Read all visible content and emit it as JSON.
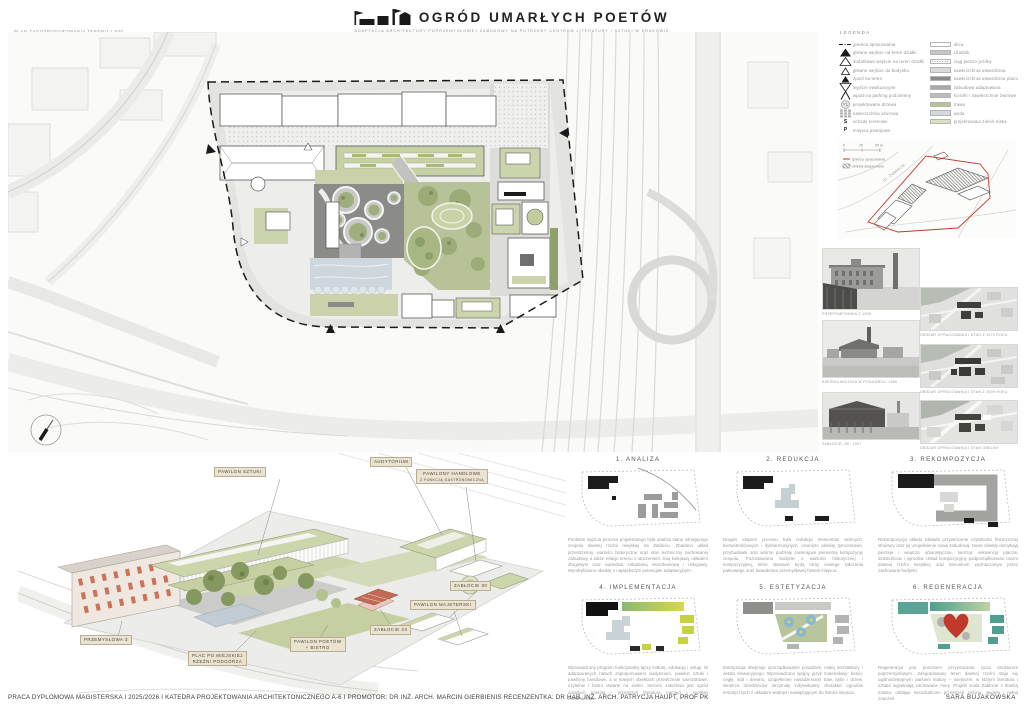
{
  "header": {
    "title": "OGRÓD UMARŁYCH POETÓW",
    "subtitle": "ADAPTACJA ARCHITEKTURY POPRZEMYSŁOWEJ ZABUDOWY NA POTRZEBY CENTRUM LITERATURY I SZTUKI W KRAKOWIE"
  },
  "site_plan": {
    "label": "PLAN ZAGOSPODAROWANIA TERENU 1:500"
  },
  "legend": {
    "title": "LEGENDA",
    "symbols": [
      {
        "label": "granica opracowania"
      },
      {
        "label": "główne wejście na teren działki"
      },
      {
        "label": "dodatkowe wejście na teren działki"
      },
      {
        "label": "główne wejście do budynku"
      },
      {
        "label": "zjazd na teren"
      },
      {
        "label": "wyjście ewakuacyjne"
      },
      {
        "label": "wjazd na parking podziemny"
      },
      {
        "label": "projektowane drzewa"
      },
      {
        "label": "nawierzchnia ażurowa"
      },
      {
        "label": "schody terenowe",
        "glyph": "S"
      },
      {
        "label": "miejsca postojowe",
        "glyph": "P"
      }
    ],
    "surfaces": [
      {
        "color": "#ffffff",
        "label": "ulica"
      },
      {
        "color": "#c6c6c4",
        "label": "chodnik"
      },
      {
        "color": "#ffffff",
        "label": "ciąg pieszo-jezdny"
      },
      {
        "color": "#dadad8",
        "label": "nawierzchnia utwardzona"
      },
      {
        "color": "#8b8b89",
        "label": "nawierzchnia utwardzona placu"
      },
      {
        "color": "#a9a9a7",
        "label": "zabudowa adaptowana"
      },
      {
        "color": "#bcbcba",
        "label": "ścieżki i nawierzchnie żwirowe"
      },
      {
        "color": "#b5c295",
        "label": "trawa"
      },
      {
        "color": "#d3dade",
        "label": "woda"
      },
      {
        "color": "#d9e0c4",
        "label": "projektowana zieleń niska"
      }
    ]
  },
  "location_map": {
    "street_label": "ul. Zabłocie",
    "scale_ticks": [
      "0",
      "25",
      "50 m"
    ],
    "key": [
      {
        "label": "granica opracowania"
      },
      {
        "label": "obiekty adaptowane"
      }
    ]
  },
  "photos": [
    {
      "caption": "PRZEPOMPOWNIA Z 1905"
    },
    {
      "caption": "RZEŹNIA MIEJSKA W PODGÓRZU, 1900"
    },
    {
      "caption": "ZABŁOCIE, OK. 1907"
    }
  ],
  "aerial_maps": [
    {
      "caption": "OBSZAR OPRACOWANIA I STAN Z 1970 ROKU"
    },
    {
      "caption": "OBSZAR OPRACOWANIA I STAN Z 2009 ROKU"
    },
    {
      "caption": "OBSZAR OPRACOWANIA I STAN OBECNY"
    }
  ],
  "axonometric": {
    "labels": [
      {
        "text": "PAWILON SZTUKI"
      },
      {
        "text": "AUDYTORIUM"
      },
      {
        "text": "PAWILONY HANDLOWE",
        "text2": "Z FUNKCJĄ GASTRONOMICZNĄ"
      },
      {
        "text": "ZABŁOCIE 30"
      },
      {
        "text": "PAWILON MAJSTERSKI"
      },
      {
        "text": "ZABŁOCIE 23"
      },
      {
        "text": "PAWILON POETÓW",
        "text2": "+ BISTRO"
      },
      {
        "text": "PRZEMYSŁOWA 3"
      },
      {
        "text": "PLAC PO MIEJSKIEJ",
        "text2": "RZEŹNI PODGÓRZA"
      }
    ]
  },
  "process": {
    "steps": [
      {
        "title": "1. ANALIZA",
        "text": "Punktem wyjścia procesu projektowego była analiza stanu istniejącego zespołu dawnej rzeźni miejskiej na Zabłociu. Zbadano układ przestrzenny, wartości historyczne oraz stan techniczny zachowanej zabudowy, a także relacje terenu z otoczeniem: linią kolejową, układem drogowym oraz sąsiednią zabudową mieszkaniową i usługową. Wyodrębniono obiekty o największym potencjale adaptacyjnym."
      },
      {
        "title": "2. REDUKCJA",
        "text": "Drugim etapem procesu była redukcja elementów wtórnych, bezwartościowych i dysharmonijnych. Usunięto obiekty tymczasowe, przybudówki oraz wtórne podziały zacierające pierwotną kompozycję zespołu. Pozostawiono budynki o wartości historycznej i kompozycyjnej, które stanowić będą ramy nowego założenia parkowego oraz świadectwo przemysłowej historii miejsca."
      },
      {
        "title": "3. REKOMPOZYCJA",
        "text": "Rekompozycja układu zakłada przywrócenie czytelności historycznej struktury oraz jej uzupełnienie nową zabudową. Nowe obiekty domykają pierzeje i wnętrza urbanistyczne, tworząc sekwencję placów, dziedzińców i ogrodów. Układ kompozycyjny podporządkowano osiom dawnej rzeźni miejskiej oraz kierunkom wyznaczonym przez zachowane budynki."
      },
      {
        "title": "4. IMPLEMENTACJA",
        "text": "Wprowadzony program funkcjonalny łączy kulturę, edukację i usługi. W adaptowanych halach zaproponowano audytorium, pawilon sztuki i pawilony handlowe, a w nowych obiektach przestrzenie warsztatowe, czytelnie i bistro otwarte na zieleń. Sercem założenia jest ogród umarłych poetów – przestrzeń literatury, pamięci i spotkań mieszkańców."
      },
      {
        "title": "5. ESTETYZACJA",
        "text": "Estetyzacja obejmuje uporządkowanie posadzek, małej architektury i detalu elewacyjnego. Wprowadzono spójny język materiałowy: beton, cegłę, stal i drewno, uzupełnione nasadzeniami traw, bylin i drzew. Wnętrza dziedzińców otrzymały indywidualny charakter ogrodów tematycznych z układem wodnym nawiązującym do historii miejsca."
      },
      {
        "title": "6. REGENERACJA",
        "text": "Regeneracja jest procesem przywracania życia strukturom poprzemysłowym. Zdegradowany teren dawnej rzeźni staje się ogólnodostępnym parkiem kultury – miejscem, w którym literatura i sztuka wypełniają zachowane mury. Projekt scala Zabłocie z tkanką miasta, oddając mieszkańcom przestrzeń zieloną, otwartą i pełną znaczeń."
      }
    ]
  },
  "footer": {
    "left": "PRACA DYPLOMOWA MAGISTERSKA I 2025/2026 I KATEDRA PROJEKTOWANIA ARCHITEKTONICZNEGO A-6 I PROMOTOR: DR INŻ. ARCH. MARCIN GIERBIENIS RECENZENTKA: DR HAB. INŻ. ARCH. PATRYCJA HAUPT, PROF PK",
    "right": "SARA BUJAKOWSKA"
  },
  "colors": {
    "roof_green": "#c7d1a3",
    "lawn_green": "#b7c298",
    "paving_dark": "#8b8b89",
    "water": "#ced7dd",
    "label_beige": "#eae3d1",
    "boundary_red": "#c0392b",
    "heart_red": "#c0392b",
    "ink": "#1a1a1a"
  }
}
